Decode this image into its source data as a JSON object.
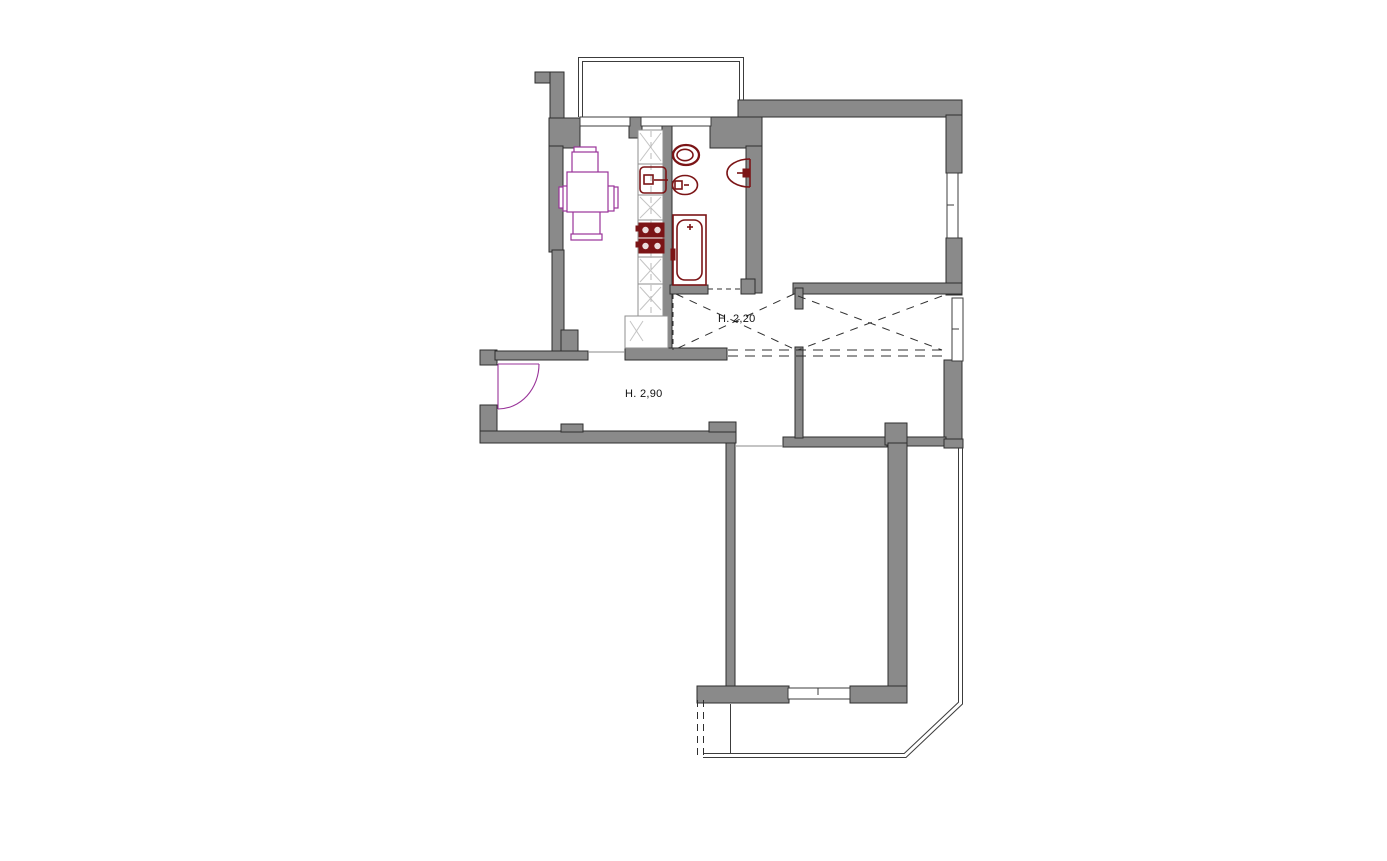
{
  "document": {
    "type": "apartment-floor-plan",
    "style": "CAD architectural drawing, top view"
  },
  "labels": {
    "corridor_height": "H. 2,20",
    "hall_height": "H. 2,90",
    "stove_text": "SC FO"
  },
  "colors": {
    "background": "#ffffff",
    "wall": "#8a8a8a",
    "wall_outline": "#2e2e2e",
    "plumbing": "#7b1416",
    "furniture": "#993399",
    "thin_line": "#3c3c3c",
    "dashed_line": "#2f2f2f",
    "counter_line": "#8f8f8f",
    "cabinet_mark": "#c4c4c4",
    "text": "#111111"
  },
  "symbols": {
    "kitchen": [
      "dining-table",
      "chair",
      "kitchen-counter",
      "kitchen-sink",
      "stove",
      "fridge"
    ],
    "bathroom": [
      "toilet",
      "bidet",
      "washbasin",
      "bathtub"
    ],
    "openings": [
      "entrance-door",
      "window",
      "door-opening"
    ],
    "annotations": [
      "lowered-ceiling-cross",
      "balcony-outline"
    ]
  }
}
